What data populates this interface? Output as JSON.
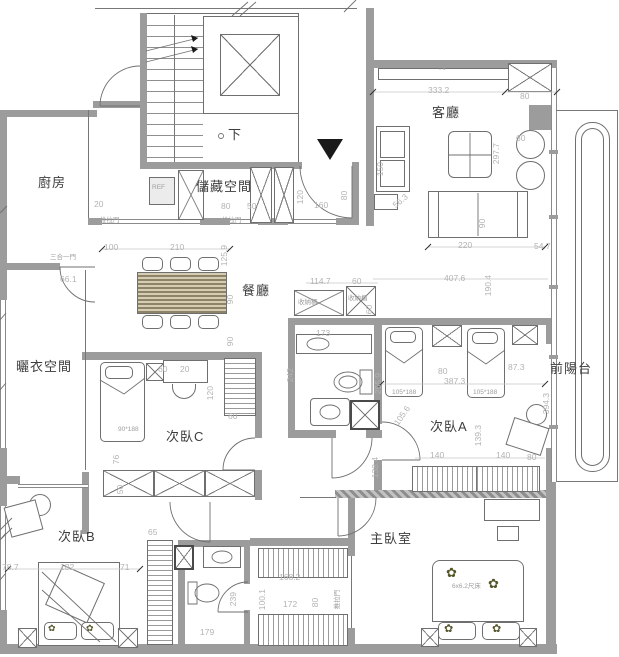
{
  "drawing_type": "apartment floor plan",
  "colors": {
    "wall": "#9c9c9c",
    "line": "#6f6f6f",
    "dimension_text": "#b3b3b3",
    "room_text": "#3d3d3d"
  },
  "labels": [
    {
      "t": "廚房",
      "x": 38,
      "y": 176,
      "c": "room"
    },
    {
      "t": "儲藏空間",
      "x": 196,
      "y": 180,
      "c": "room"
    },
    {
      "t": "客廳",
      "x": 432,
      "y": 106,
      "c": "room"
    },
    {
      "t": "餐廳",
      "x": 242,
      "y": 284,
      "c": "room"
    },
    {
      "t": "曬衣空間",
      "x": 16,
      "y": 360,
      "c": "room"
    },
    {
      "t": "次臥C",
      "x": 166,
      "y": 430,
      "c": "room"
    },
    {
      "t": "次臥A",
      "x": 430,
      "y": 420,
      "c": "room"
    },
    {
      "t": "次臥B",
      "x": 58,
      "y": 530,
      "c": "room"
    },
    {
      "t": "主臥室",
      "x": 370,
      "y": 532,
      "c": "room"
    },
    {
      "t": "前陽台",
      "x": 550,
      "y": 362,
      "c": "room"
    },
    {
      "t": "下",
      "x": 228,
      "y": 128,
      "c": "room"
    },
    {
      "t": "TV",
      "x": 438,
      "y": 66,
      "c": "tiny"
    },
    {
      "t": "REF",
      "x": 152,
      "y": 185,
      "c": "tiny"
    },
    {
      "t": "333.2",
      "x": 428,
      "y": 86
    },
    {
      "t": "80",
      "x": 520,
      "y": 92
    },
    {
      "t": "60",
      "x": 516,
      "y": 134
    },
    {
      "t": "297.7",
      "x": 496,
      "y": 160,
      "r": -90
    },
    {
      "t": "150",
      "x": 380,
      "y": 172,
      "r": -90
    },
    {
      "t": "56.3",
      "x": 394,
      "y": 202,
      "r": -40
    },
    {
      "t": "90",
      "x": 482,
      "y": 224,
      "r": -90
    },
    {
      "t": "220",
      "x": 458,
      "y": 241
    },
    {
      "t": "54.7",
      "x": 534,
      "y": 242
    },
    {
      "t": "407.6",
      "x": 444,
      "y": 274
    },
    {
      "t": "190.4",
      "x": 488,
      "y": 292,
      "r": -90
    },
    {
      "t": "160",
      "x": 314,
      "y": 201
    },
    {
      "t": "120",
      "x": 300,
      "y": 200,
      "r": -90
    },
    {
      "t": "80",
      "x": 344,
      "y": 196,
      "r": -90
    },
    {
      "t": "20",
      "x": 94,
      "y": 200
    },
    {
      "t": "推拉門",
      "x": 100,
      "y": 218,
      "c": "tiny"
    },
    {
      "t": "80",
      "x": 221,
      "y": 202
    },
    {
      "t": "50",
      "x": 247,
      "y": 202
    },
    {
      "t": "推拉門",
      "x": 222,
      "y": 218,
      "c": "tiny"
    },
    {
      "t": "100",
      "x": 104,
      "y": 243
    },
    {
      "t": "210",
      "x": 170,
      "y": 243
    },
    {
      "t": "125.9",
      "x": 224,
      "y": 262,
      "r": -90
    },
    {
      "t": "90",
      "x": 230,
      "y": 300,
      "r": -90
    },
    {
      "t": "90",
      "x": 230,
      "y": 342,
      "r": -90
    },
    {
      "t": "66.1",
      "x": 60,
      "y": 275
    },
    {
      "t": "三合一門",
      "x": 50,
      "y": 255,
      "c": "tiny"
    },
    {
      "t": "114.7",
      "x": 310,
      "y": 277
    },
    {
      "t": "60",
      "x": 352,
      "y": 277
    },
    {
      "t": "60",
      "x": 369,
      "y": 310,
      "r": -90
    },
    {
      "t": "收納櫃",
      "x": 298,
      "y": 300,
      "c": "tiny"
    },
    {
      "t": "收納櫃",
      "x": 348,
      "y": 296,
      "c": "tiny"
    },
    {
      "t": "173",
      "x": 316,
      "y": 329
    },
    {
      "t": "242",
      "x": 290,
      "y": 378,
      "r": -90
    },
    {
      "t": "255.9",
      "x": 378,
      "y": 390,
      "r": -90
    },
    {
      "t": "80",
      "x": 438,
      "y": 367
    },
    {
      "t": "87.3",
      "x": 508,
      "y": 363
    },
    {
      "t": "387.3",
      "x": 444,
      "y": 377
    },
    {
      "t": "105*188",
      "x": 392,
      "y": 390,
      "c": "tiny"
    },
    {
      "t": "105*188",
      "x": 473,
      "y": 390,
      "c": "tiny"
    },
    {
      "t": "139.3",
      "x": 478,
      "y": 442,
      "r": -90
    },
    {
      "t": "105.6",
      "x": 396,
      "y": 420,
      "r": -55
    },
    {
      "t": "138.4",
      "x": 375,
      "y": 474,
      "r": -90
    },
    {
      "t": "140",
      "x": 430,
      "y": 451
    },
    {
      "t": "140",
      "x": 496,
      "y": 451
    },
    {
      "t": "80",
      "x": 527,
      "y": 453
    },
    {
      "t": "394.3",
      "x": 546,
      "y": 410,
      "r": -90
    },
    {
      "t": "60",
      "x": 158,
      "y": 365
    },
    {
      "t": "20",
      "x": 180,
      "y": 365
    },
    {
      "t": "120",
      "x": 210,
      "y": 396,
      "r": -90
    },
    {
      "t": "60",
      "x": 228,
      "y": 412
    },
    {
      "t": "90*188",
      "x": 118,
      "y": 427,
      "c": "tiny"
    },
    {
      "t": "76",
      "x": 116,
      "y": 460,
      "r": -90
    },
    {
      "t": "50",
      "x": 120,
      "y": 490,
      "r": -90
    },
    {
      "t": "78.7",
      "x": 2,
      "y": 563
    },
    {
      "t": "182",
      "x": 60,
      "y": 563
    },
    {
      "t": "71",
      "x": 120,
      "y": 563
    },
    {
      "t": "65",
      "x": 148,
      "y": 528
    },
    {
      "t": "168.2",
      "x": 279,
      "y": 573
    },
    {
      "t": "100.1",
      "x": 262,
      "y": 606,
      "r": -90
    },
    {
      "t": "172",
      "x": 283,
      "y": 600
    },
    {
      "t": "80",
      "x": 315,
      "y": 603,
      "r": -90
    },
    {
      "t": "推拉門",
      "x": 338,
      "y": 606,
      "r": -90,
      "c": "tiny"
    },
    {
      "t": "239",
      "x": 233,
      "y": 602,
      "r": -90
    },
    {
      "t": "179",
      "x": 200,
      "y": 628
    },
    {
      "t": "6x6.2尺床",
      "x": 452,
      "y": 584,
      "c": "tiny"
    }
  ],
  "decor": {
    "flower_glyph": "✿",
    "entry_glyph": "▼",
    "flowers": [
      {
        "x": 446,
        "y": 566,
        "s": 13
      },
      {
        "x": 488,
        "y": 577,
        "s": 13
      },
      {
        "x": 444,
        "y": 624,
        "s": 11
      },
      {
        "x": 492,
        "y": 624,
        "s": 11
      },
      {
        "x": 48,
        "y": 624,
        "s": 9
      },
      {
        "x": 86,
        "y": 624,
        "s": 9
      }
    ]
  }
}
